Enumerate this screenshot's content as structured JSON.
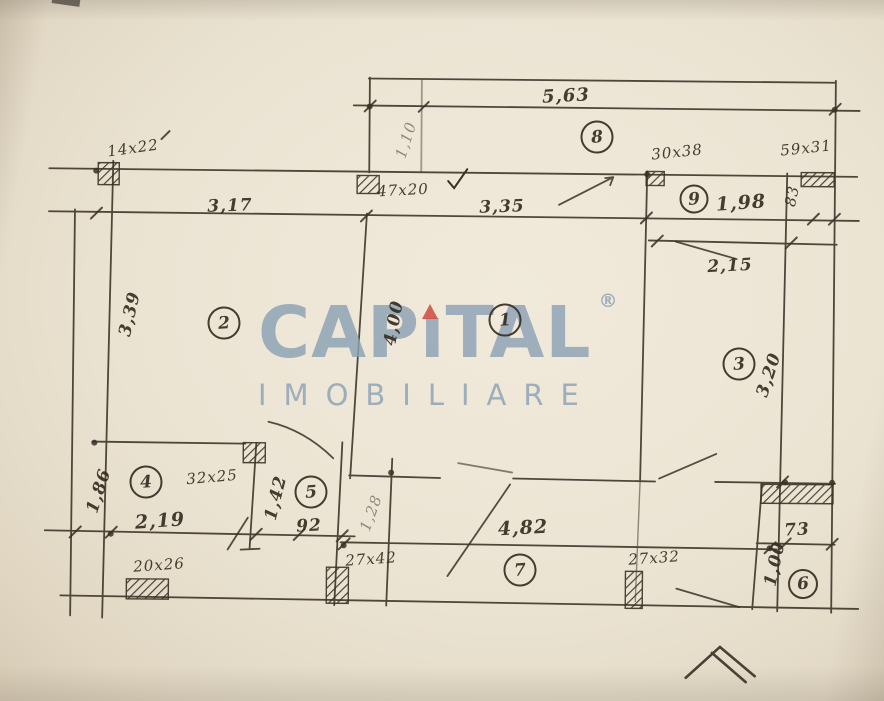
{
  "watermark": {
    "part1": "CAP",
    "letter_i": "ı",
    "part2": "TAL",
    "registered": "®",
    "subtitle": "IMOBILIARE",
    "color": "#8ba1b4",
    "accent": "#ce493e"
  },
  "rooms": {
    "r1": "1",
    "r2": "2",
    "r3": "3",
    "r4": "4",
    "r5": "5",
    "r6": "6",
    "r7": "7",
    "r8": "8",
    "r9": "9"
  },
  "dims": {
    "d14x22": "14x22",
    "d317": "3,17",
    "d47x20": "47x20",
    "d110": "1,10",
    "d335": "3,35",
    "d563": "5,63",
    "d30x38": "30x38",
    "d59x31": "59x31",
    "d198": "1,98",
    "d83": "83",
    "d215": "2,15",
    "d339": "3,39",
    "d400": "4,00",
    "d320": "3,20",
    "d186": "1,86",
    "d32x25": "32x25",
    "d219": "2,19",
    "d142": "1,42",
    "d92": "92",
    "d128": "1,28",
    "d482": "4,82",
    "d20x26": "20x26",
    "d27x42": "27x42",
    "d27x32": "27x32",
    "d73": "73",
    "d100": "1,00"
  },
  "colors": {
    "paper": "#ebe3d2",
    "ink": "#3a3126",
    "watermark": "#8ba1b4",
    "accent": "#ce493e"
  }
}
